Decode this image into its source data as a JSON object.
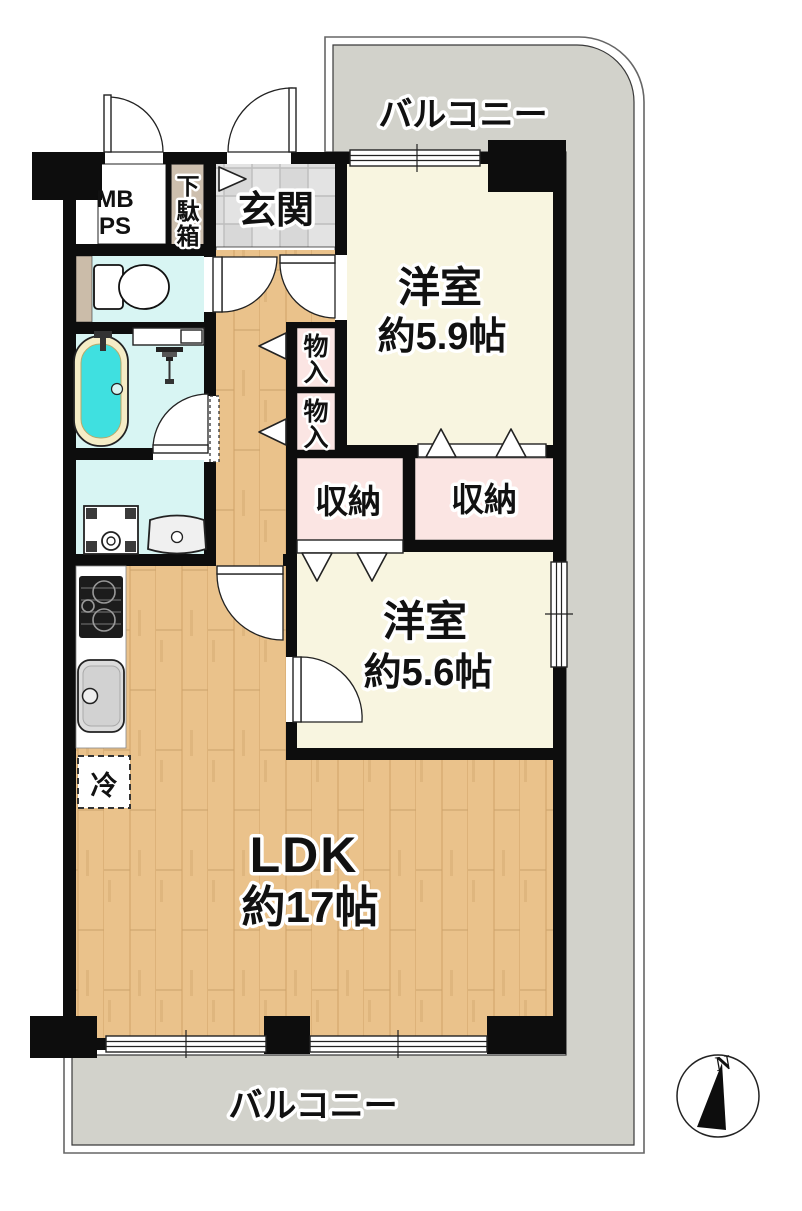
{
  "floor_plan": {
    "balcony_top_label": "バルコニー",
    "balcony_bottom_label": "バルコニー",
    "entrance_label": "玄関",
    "mb_ps": {
      "line1": "MB",
      "line2": "PS"
    },
    "shoe_cabinet": {
      "char1": "下",
      "char2": "駄",
      "char3": "箱"
    },
    "western_room_59": {
      "name": "洋室",
      "size": "約5.9帖"
    },
    "western_room_56": {
      "name": "洋室",
      "size": "約5.6帖"
    },
    "ldk": {
      "name": "LDK",
      "size": "約17帖"
    },
    "storage_top": {
      "char1": "物",
      "char2": "入"
    },
    "storage_bottom": {
      "char1": "物",
      "char2": "入"
    },
    "closet_left_label": "収納",
    "closet_right_label": "収納",
    "fridge_label": "冷",
    "compass_north_label": "N",
    "colors": {
      "wall": "#0d0d0d",
      "balcony": "#d2d2cb",
      "wood_floor": "#eac28b",
      "room_cream": "#f8f5e0",
      "wet_area_cyan": "#d8f5f3",
      "closet_pink": "#fbe5e3",
      "tub_water": "#3fe0e0",
      "shoe_cabinet_tan": "#cdbfae",
      "entrance_tile": "#e2e2e2"
    }
  }
}
